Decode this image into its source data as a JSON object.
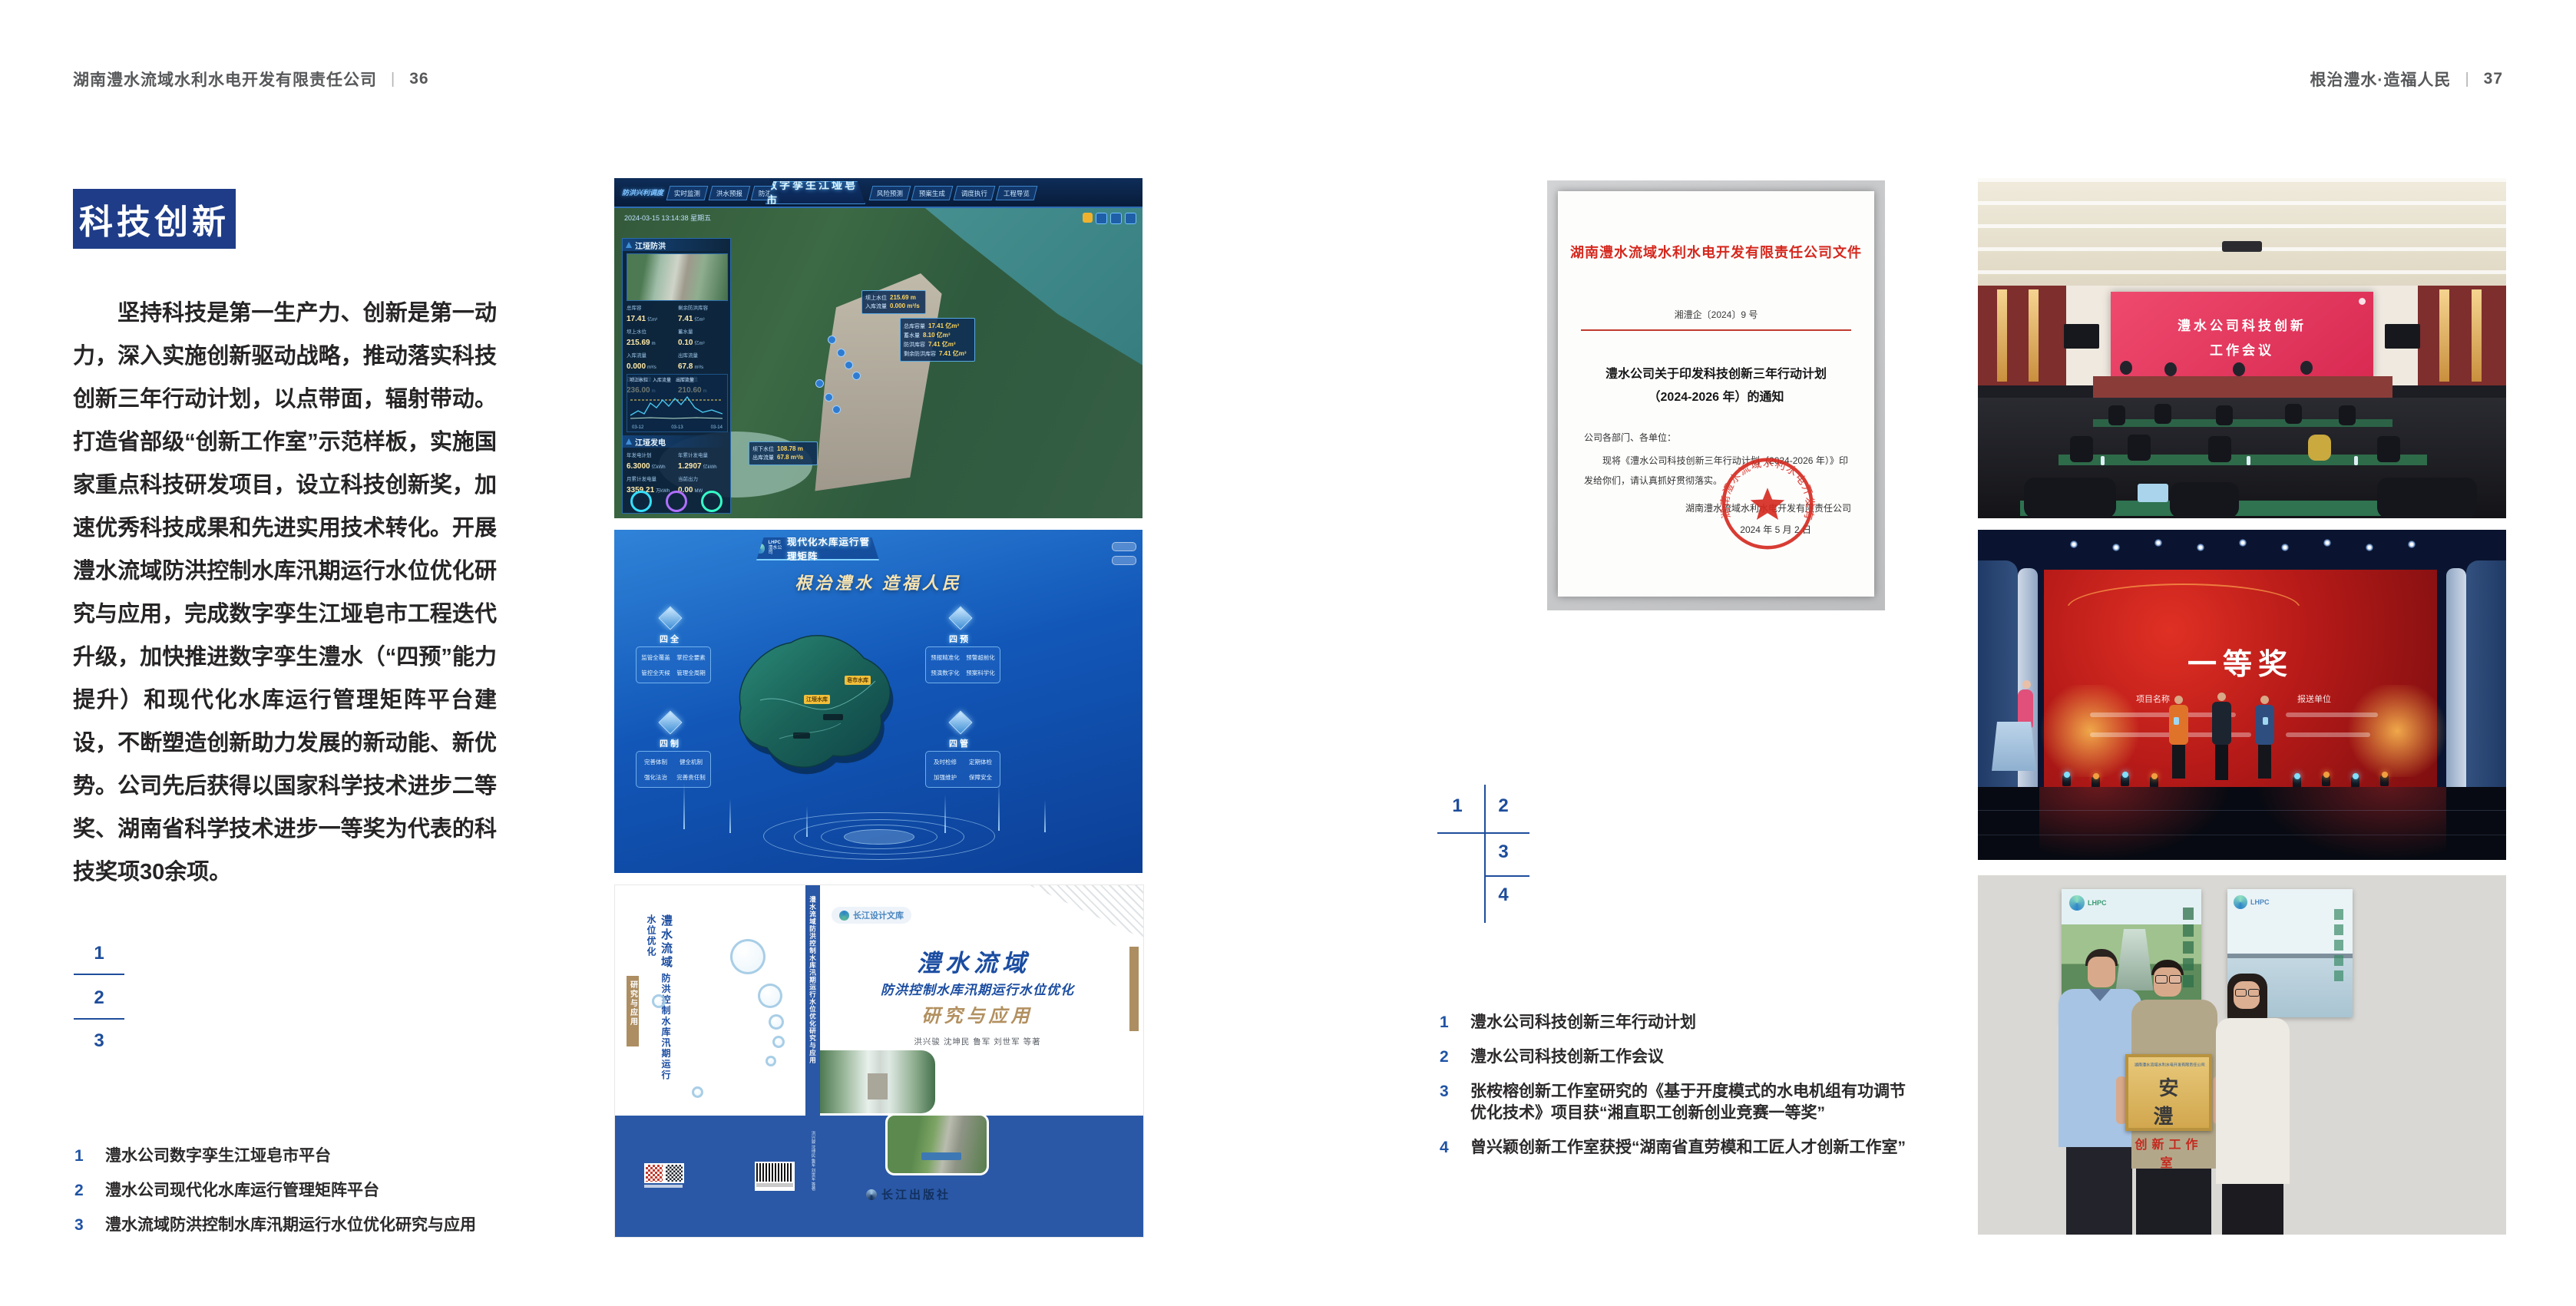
{
  "header_left": {
    "text": "湖南澧水流域水利水电开发有限责任公司",
    "sep": "|",
    "page": "36"
  },
  "header_right": {
    "text": "根治澧水·造福人民",
    "sep": "|",
    "page": "37"
  },
  "colors": {
    "accent_blue": "#1e3c87",
    "caption_blue": "#2053a4",
    "doc_red": "#d5281e",
    "band_blue": "#2a58a6",
    "gold": "#b29060"
  },
  "left_page": {
    "section_title": "科技创新",
    "paragraph": "坚持科技是第一生产力、创新是第一动力，深入实施创新驱动战略，推动落实科技创新三年行动计划，以点带面，辐射带动。打造省部级“创新工作室”示范样板，实施国家重点科技研发项目，设立科技创新奖，加速优秀科技成果和先进实用技术转化。开展澧水流域防洪控制水库汛期运行水位优化研究与应用，完成数字孪生江垭皂市工程迭代升级，加快推进数字孪生澧水（“四预”能力提升）和现代化水库运行管理矩阵平台建设，不断塑造创新助力发展的新动能、新优势。公司先后获得以国家科学技术进步二等奖、湖南省科学技术进步一等奖为代表的科技奖项30余项。",
    "figure_index": [
      "1",
      "2",
      "3"
    ],
    "captions": [
      {
        "num": "1",
        "text": "澧水公司数字孪生江垭皂市平台"
      },
      {
        "num": "2",
        "text": "澧水公司现代化水库运行管理矩阵平台"
      },
      {
        "num": "3",
        "text": "澧水流域防洪控制水库汛期运行水位优化研究与应用"
      }
    ]
  },
  "right_page": {
    "figure_index": [
      "1",
      "2",
      "3",
      "4"
    ],
    "captions": [
      {
        "num": "1",
        "text": "澧水公司科技创新三年行动计划"
      },
      {
        "num": "2",
        "text": "澧水公司科技创新工作会议"
      },
      {
        "num": "3",
        "text": "张桉榕创新工作室研究的《基于开度模式的水电机组有功调节优化技术》项目获“湘直职工创新创业竞赛一等奖”"
      },
      {
        "num": "4",
        "text": "曾兴颖创新工作室获授“湖南省直劳模和工匠人才创新工作室”"
      }
    ]
  },
  "dashboard": {
    "title": "数字孪生江垭皂市",
    "corner_label": "防洪兴利调度",
    "timestamp": "2024-03-15 13:14:38 星期五",
    "tabs_left": [
      "实时监测",
      "洪水预报",
      "防洪预演"
    ],
    "tabs_right": [
      "风险预测",
      "预案生成",
      "调度执行",
      "工程导览"
    ],
    "panel_flood_title": "江垭防洪",
    "flood_stats": [
      {
        "label": "总库容",
        "value": "17.41",
        "unit": "亿m³"
      },
      {
        "label": "剩余防洪库容",
        "value": "7.41",
        "unit": "亿m³"
      },
      {
        "label": "坝上水位",
        "value": "215.69",
        "unit": "m"
      },
      {
        "label": "蓄水量",
        "value": "0.10",
        "unit": "亿m³"
      },
      {
        "label": "入库流量",
        "value": "0.000",
        "unit": "m³/s"
      },
      {
        "label": "出库流量",
        "value": "67.8",
        "unit": "m³/s"
      },
      {
        "label": "正常蓄水位",
        "value": "236.00",
        "unit": "m"
      },
      {
        "label": "汛限水位",
        "value": "210.60",
        "unit": "m"
      }
    ],
    "chart_legend": [
      "坝上水位",
      "入库流量",
      "出库流量"
    ],
    "chart_xticks": [
      "03-12",
      "03-13",
      "03-14"
    ],
    "panel_power_title": "江垭发电",
    "power_stats": [
      {
        "label": "年发电计划",
        "value": "6.3000",
        "unit": "亿kWh"
      },
      {
        "label": "年累计发电量",
        "value": "1.2907",
        "unit": "亿kWh"
      },
      {
        "label": "月累计发电量",
        "value": "3359.21",
        "unit": "万kWh"
      },
      {
        "label": "当前出力",
        "value": "0.00",
        "unit": "MW"
      }
    ],
    "callout_up": [
      {
        "label": "坝上水位",
        "value": "215.69 m"
      },
      {
        "label": "入库流量",
        "value": "0.000 m³/s"
      }
    ],
    "callout_info": [
      {
        "label": "总库容量",
        "value": "17.41 亿m³"
      },
      {
        "label": "蓄水量",
        "value": "8.10 亿m³"
      },
      {
        "label": "防洪库容",
        "value": "7.41 亿m³"
      },
      {
        "label": "剩余防洪库容",
        "value": "7.41 亿m³"
      }
    ],
    "callout_down": [
      {
        "label": "坝下水位",
        "value": "108.78 m"
      },
      {
        "label": "出库流量",
        "value": "67.8 m³/s"
      }
    ]
  },
  "matrix": {
    "logo_text": "LHPC",
    "logo_sub": "澧水公司",
    "title": "现代化水库运行管理矩阵",
    "slogan": "根治澧水  造福人民",
    "groups": [
      {
        "name": "四全",
        "items": [
          "监管全覆盖",
          "掌控全要素",
          "管控全天候",
          "管理全周期"
        ]
      },
      {
        "name": "四预",
        "items": [
          "预报精准化",
          "预警超前化",
          "预演数字化",
          "预案科学化"
        ]
      },
      {
        "name": "四制",
        "items": [
          "完善体制",
          "健全机制",
          "强化法治",
          "完善责任制"
        ]
      },
      {
        "name": "四管",
        "items": [
          "及时检修",
          "定期体检",
          "加强维护",
          "保障安全"
        ]
      }
    ],
    "map_labels": [
      "皂市水库",
      "江垭水库"
    ]
  },
  "book": {
    "series": "长江设计文库",
    "title": "澧水流域",
    "subtitle": "防洪控制水库汛期运行水位优化",
    "subtitle2": "研究与应用",
    "authors": "洪兴骏  沈坤民  鲁军  刘世军  等著",
    "publisher": "长江出版社",
    "spine": "澧水流域防洪控制水库汛期运行水位优化研究与应用"
  },
  "document": {
    "header": "湖南澧水流域水利水电开发有限责任公司文件",
    "doc_no": "湘澧企〔2024〕9 号",
    "title_line1": "澧水公司关于印发科技创新三年行动计划",
    "title_line2": "（2024-2026 年）的通知",
    "salutation": "公司各部门、各单位：",
    "body": "现将《澧水公司科技创新三年行动计划（2024-2026 年）》印发给你们，请认真抓好贯彻落实。",
    "signer": "湖南澧水流域水利水电开发有限责任公司",
    "date": "2024 年 5 月 2 日",
    "seal_text": "湖南澧水流域水利水电开发有限责任公司"
  },
  "meeting": {
    "screen_line1": "澧水公司科技创新",
    "screen_line2": "工作会议"
  },
  "award": {
    "headline": "一等奖",
    "col1": "项目名称",
    "col2": "报送单位"
  },
  "studio": {
    "logo": "LHPC",
    "plaque_header": "湖南澧水流域水利水电开发有限责任公司",
    "plaque_chars": "安  澧",
    "plaque_sub": "创新工作室"
  }
}
